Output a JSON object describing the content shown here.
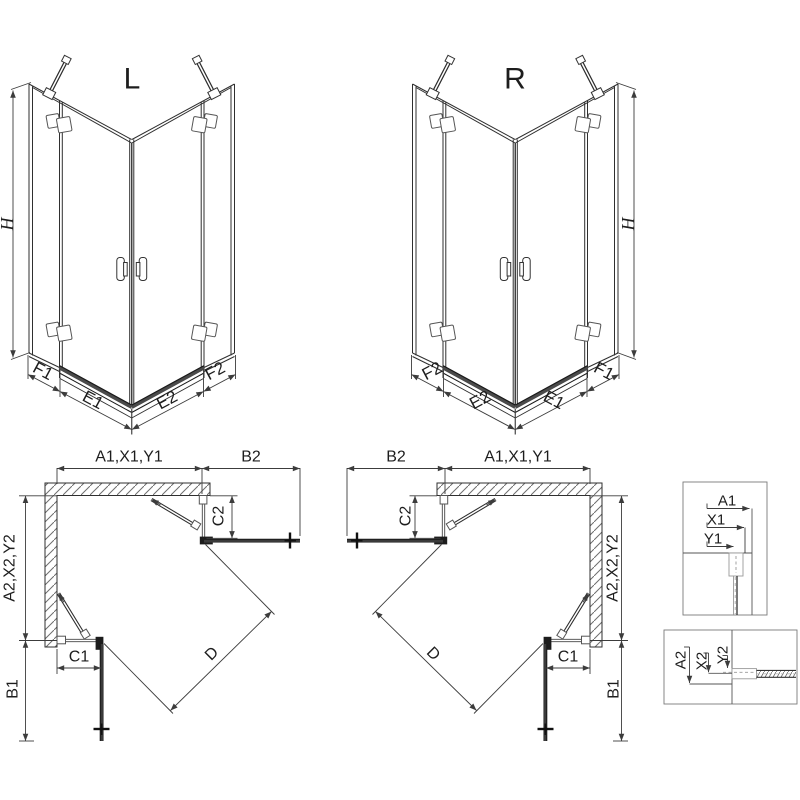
{
  "views": {
    "iso_left": {
      "title": "L",
      "height": "H",
      "dims": {
        "f1": "F1",
        "e1": "E1",
        "e2": "E2",
        "f2": "F2"
      }
    },
    "iso_right": {
      "title": "R",
      "height": "H",
      "dims": {
        "f1": "F1",
        "e1": "E1",
        "e2": "E2",
        "f2": "F2"
      }
    },
    "plan_left": {
      "top_width": "A1,X1,Y1",
      "door_top": "B2",
      "side_height": "A2,X2,Y2",
      "door_side": "B1",
      "fixed_top": "C2",
      "fixed_side": "C1",
      "diagonal": "D"
    },
    "plan_right": {
      "top_width": "A1,X1,Y1",
      "door_top": "B2",
      "side_height": "A2,X2,Y2",
      "door_side": "B1",
      "fixed_top": "C2",
      "fixed_side": "C1",
      "diagonal": "D"
    },
    "detail_profile_top": {
      "a": "A1",
      "x": "X1",
      "y": "Y1"
    },
    "detail_profile_bottom": {
      "a": "A2",
      "x": "X2",
      "y": "Y2"
    }
  },
  "colors": {
    "line": "#2f2f2f",
    "dark": "#161616",
    "dimension": "#3c3c3c",
    "hatch": "#6e6e6e",
    "box_border": "#7a7a7a",
    "background": "#ffffff"
  }
}
